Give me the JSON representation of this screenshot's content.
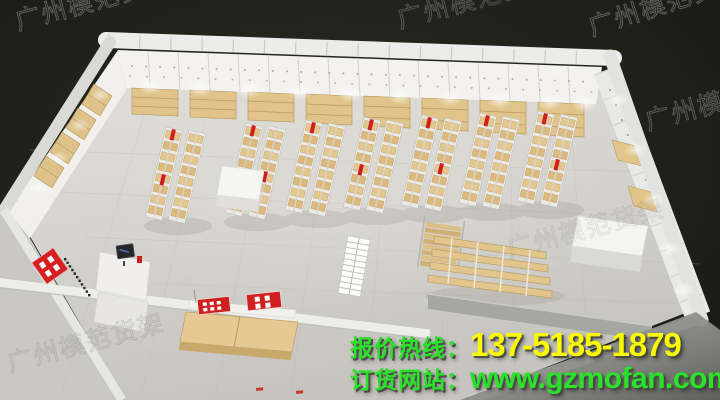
{
  "contact": {
    "hotline_label": "报价热线：",
    "hotline_number": "137-5185-1879",
    "website_label": "订货网站：",
    "website_url": "www.gzmofan.com"
  },
  "watermark": {
    "text": "广州模范货架"
  },
  "colors": {
    "hotline_label_green": "#29e229",
    "hotline_number_yellow": "#f9f900",
    "website_green": "#29e229",
    "accent_red": "#cf1f1f",
    "wood_tan": "#e3c78e",
    "wall_white": "#f3f2ef",
    "floor_gray": "#d6d4ce",
    "background_dark": "#20221a"
  }
}
